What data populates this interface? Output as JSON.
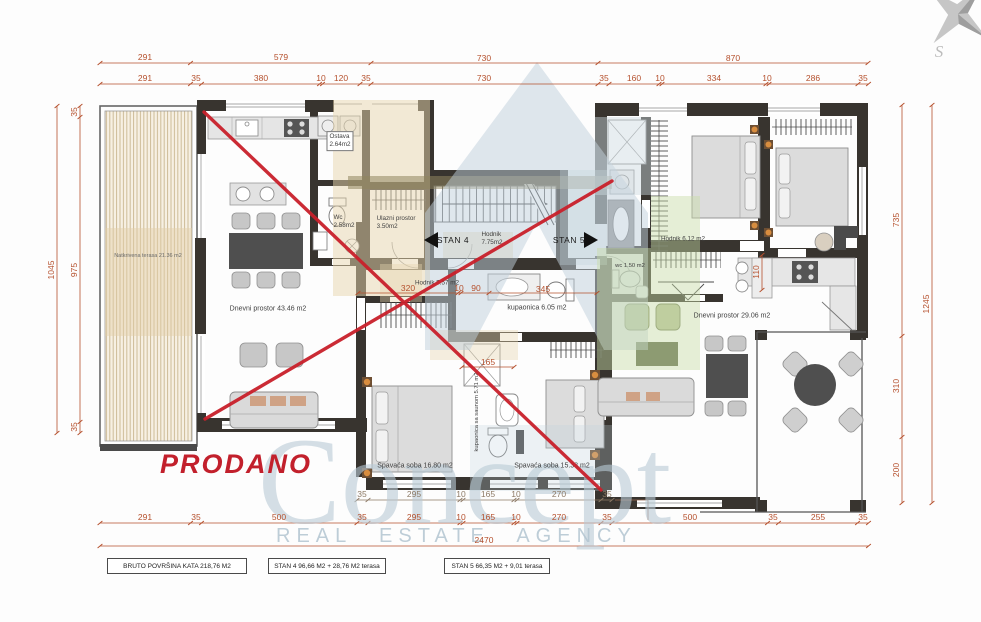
{
  "watermark": {
    "brand": "Concept",
    "tagline": "REAL ESTATE AGENCY",
    "compass_letter": "S"
  },
  "stamp": {
    "sold": "PRODANO"
  },
  "rooms": {
    "terasa": "Natkrivena terasa 21.36 m2",
    "dnevni1": "Dnevni prostor 43.46 m2",
    "ostava": [
      "Ostava",
      "2.64m2"
    ],
    "wc1": [
      "Wc",
      "2.58m2"
    ],
    "ulaz": [
      "Ulazni prostor",
      "3.50m2"
    ],
    "stan4": "STAN 4",
    "stan5": "STAN 5",
    "hodnik775": [
      "Hodnik",
      "7.75m2"
    ],
    "hodnik557": "Hodnik 5.57 m2",
    "kupaonica605": "kupaonica 6.05 m2",
    "kupaonica571": "kupaonica sa saunom 5.71 m2",
    "spavaca1": "Spavaća soba 16.80 m2",
    "spavaca2": "Spavaća soba 15.38 m2",
    "hodnik612": "Hodnik 6.12 m2",
    "wc2": "wc 1.50 m2",
    "dnevni2": "Dnevni prostor 29.06 m2"
  },
  "dims": {
    "top1": [
      "291",
      "579",
      "730",
      "870"
    ],
    "top2": [
      "291",
      "35",
      "380",
      "10",
      "120",
      "35",
      "730",
      "35",
      "160",
      "10",
      "334",
      "10",
      "286",
      "35"
    ],
    "left": [
      "1045",
      "35",
      "975",
      "35"
    ],
    "right": [
      "735",
      "310",
      "200",
      "1245"
    ],
    "inner": [
      "320",
      "10",
      "90",
      "345",
      "165",
      "110"
    ],
    "bottom_gray": [
      "35",
      "295",
      "10",
      "165",
      "10",
      "270",
      "35"
    ],
    "bottom": [
      "291",
      "35",
      "500",
      "35",
      "295",
      "10",
      "165",
      "10",
      "270",
      "35",
      "500",
      "35",
      "255",
      "35"
    ],
    "total": "2470"
  },
  "legend": {
    "box1": "BRUTO POVRŠINA KATA  218,76  M2",
    "box2": "STAN 4 96,66 M2  + 28,76 M2 terasa",
    "box3": "STAN 5 66,35 M2 + 9,01 terasa"
  },
  "colors": {
    "dimension": "#b5502d",
    "sold_red": "#c2202c",
    "wall": "#38342f",
    "watermark_blue": "#bfd0db",
    "watermark_green": "#c8dba6",
    "watermark_beige": "#e7d5ae",
    "watermark_khaki": "#8f855f",
    "lamp_orange": "#d88d3f"
  }
}
